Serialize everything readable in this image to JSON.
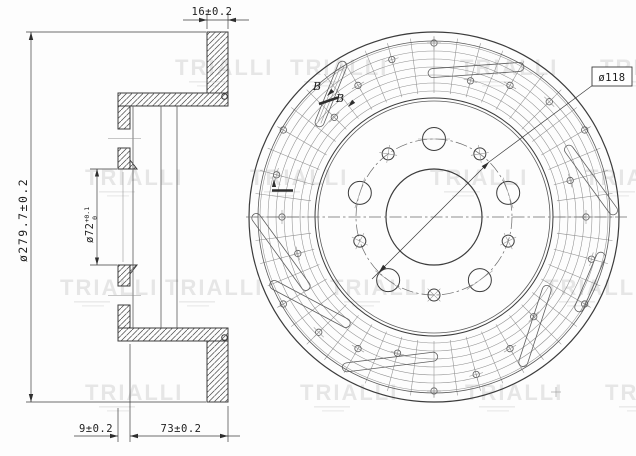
{
  "watermark": {
    "label": "TRIALLI"
  },
  "section_view": {
    "dim_disc_thickness": "16±0.2",
    "dim_outer_diameter": "ø279.7±0.2",
    "dim_bore_diameter": "ø72",
    "dim_bore_tolerance_upper": "+0.1",
    "dim_bore_tolerance_lower": "0",
    "dim_flange_thickness": "9±0.2",
    "dim_overall_depth": "73±0.2"
  },
  "front_view": {
    "dim_bolt_circle_diameter": "ø118",
    "section_mark_1": "B",
    "section_mark_2": "B"
  }
}
